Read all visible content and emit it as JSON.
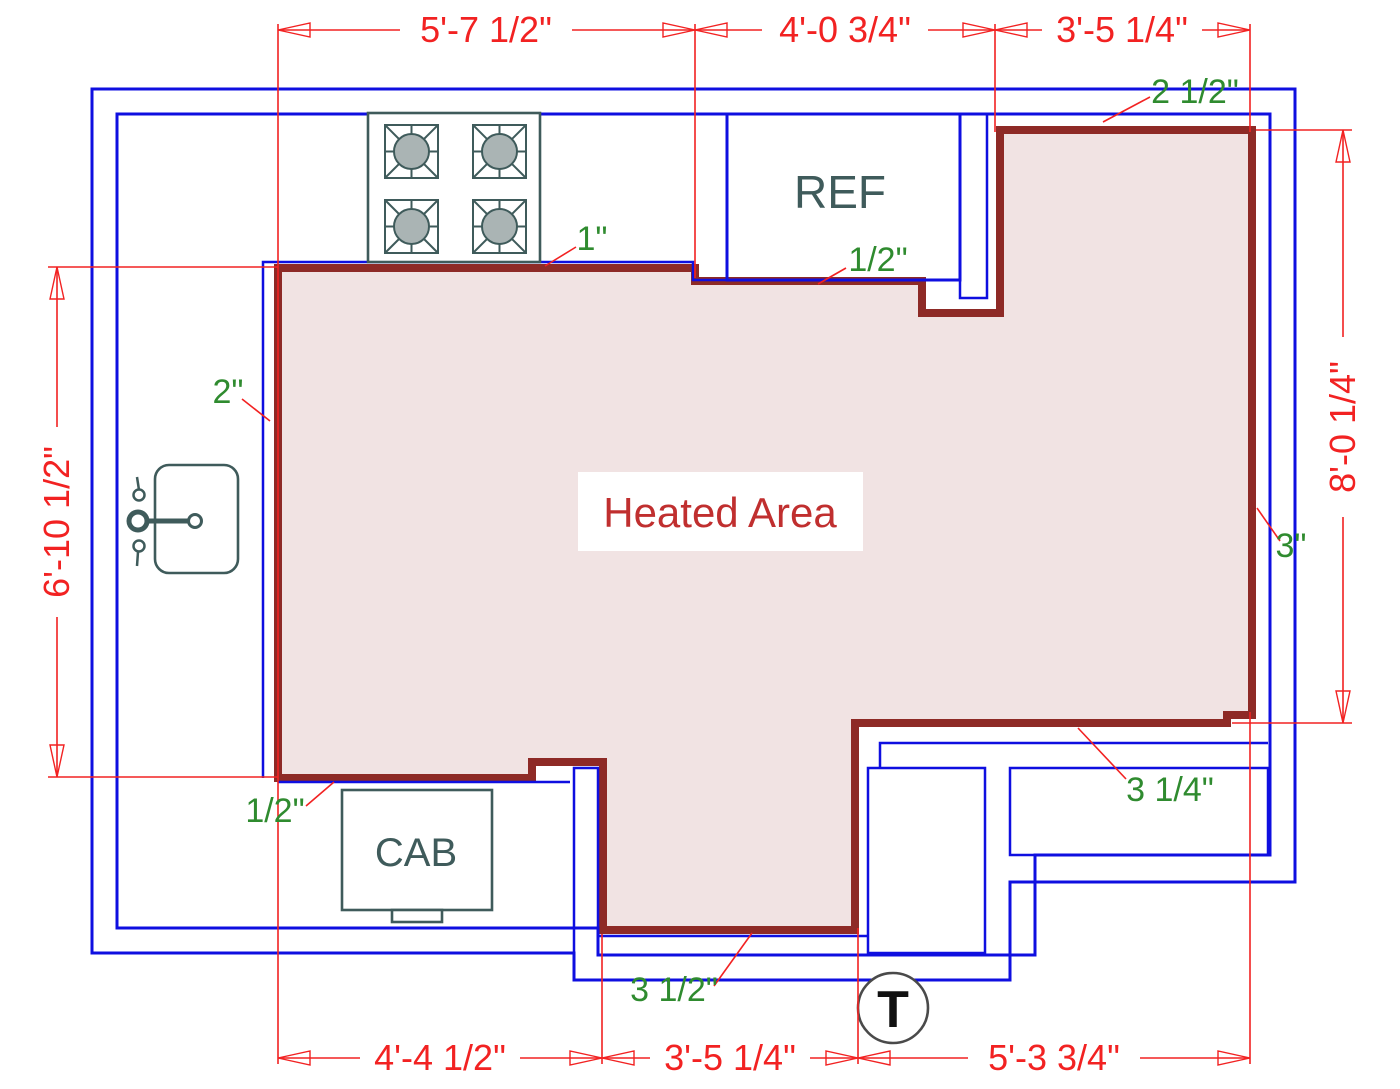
{
  "title": "Heated Area",
  "dims": {
    "top": [
      "5'-7 1/2\"",
      "4'-0 3/4\"",
      "3'-5 1/4\""
    ],
    "bottom": [
      "4'-4 1/2\"",
      "3'-5 1/4\"",
      "5'-3 3/4\""
    ],
    "left": "6'-10 1/2\"",
    "right": "8'-0 1/4\""
  },
  "callouts": {
    "top_wall": "2 1/2\"",
    "stove_wall": "1\"",
    "ref_wall": "1/2\"",
    "left_wall": "2\"",
    "right_wall": "3\"",
    "bottom_right_wall": "3 1/4\"",
    "bottom_wall": "3 1/2\"",
    "cab_wall": "1/2\""
  },
  "fixtures": {
    "ref": "REF",
    "cab": "CAB",
    "thermostat": "T"
  },
  "colors": {
    "wall_blue": "#0f0fe0",
    "heated_boundary": "#8e2a26",
    "heated_fill": "#f1e3e3",
    "dimension_red": "#f22222",
    "callout_green": "#2f8b2f",
    "fixture_slate": "#3f5b5b",
    "heated_label_red": "#c02f2f"
  }
}
